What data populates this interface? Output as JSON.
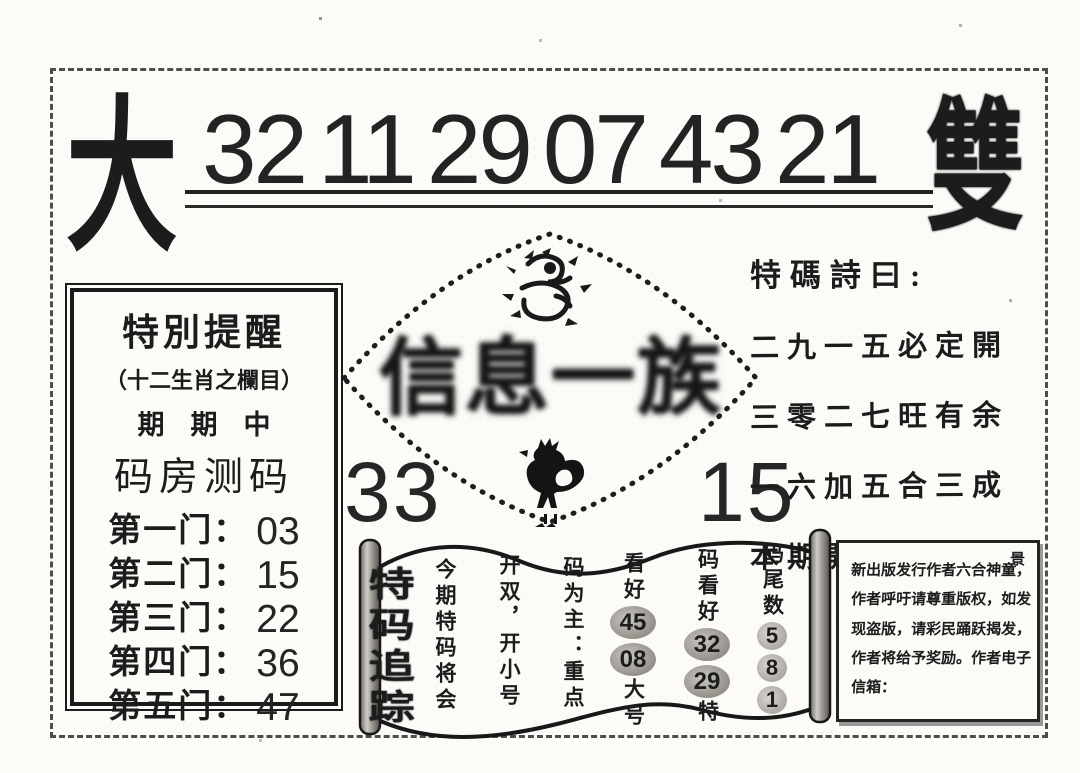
{
  "page": {
    "left_big_char": "大",
    "right_big_char": "雙",
    "top_numbers": [
      "32",
      "11",
      "29",
      "07",
      "43",
      "21"
    ]
  },
  "alert_box": {
    "title": "特別提醒",
    "subtitle": "（十二生肖之欄目）",
    "line_everyperiod": "期期中",
    "line_codehouse": "码房测码",
    "doors": [
      {
        "label": "第一门：",
        "value": "03"
      },
      {
        "label": "第二门：",
        "value": "15"
      },
      {
        "label": "第三门：",
        "value": "22"
      },
      {
        "label": "第四门：",
        "value": "36"
      },
      {
        "label": "第五门：",
        "value": "47"
      }
    ]
  },
  "center": {
    "brand": "信息一族",
    "left_number": "33",
    "right_number": "15",
    "icons": {
      "top": "dragon",
      "bottom": "rooster"
    }
  },
  "poem": {
    "title": "特碼詩曰:",
    "lines": [
      "二九一五必定開",
      "三零二七旺有余",
      "一六加五合三成",
      "本期開大單有中"
    ]
  },
  "scroll": {
    "title": "特码追踪",
    "columns": [
      {
        "text": "今期特码将会"
      },
      {
        "text": "开双，开小号"
      },
      {
        "text": "码为主：重点"
      },
      {
        "top": "看好",
        "nums": [
          "45",
          "08"
        ],
        "bottom": "大号"
      },
      {
        "top": "码看好",
        "nums": [
          "32",
          "29"
        ],
        "bottom": "特"
      },
      {
        "top": "码尾数",
        "nums": [
          "5",
          "8",
          "1"
        ],
        "bottom": ""
      }
    ]
  },
  "notice_box": {
    "corner_char": "景",
    "lines": [
      "新出版发行作者六合神童，",
      "作者呼吁请尊重版权，如发",
      "现盗版，请彩民踊跃揭发，",
      "作者将给予奖励。作者电子",
      "信箱："
    ]
  },
  "colors": {
    "ink": "#1c1c1c",
    "paper": "#fcfbf8"
  }
}
